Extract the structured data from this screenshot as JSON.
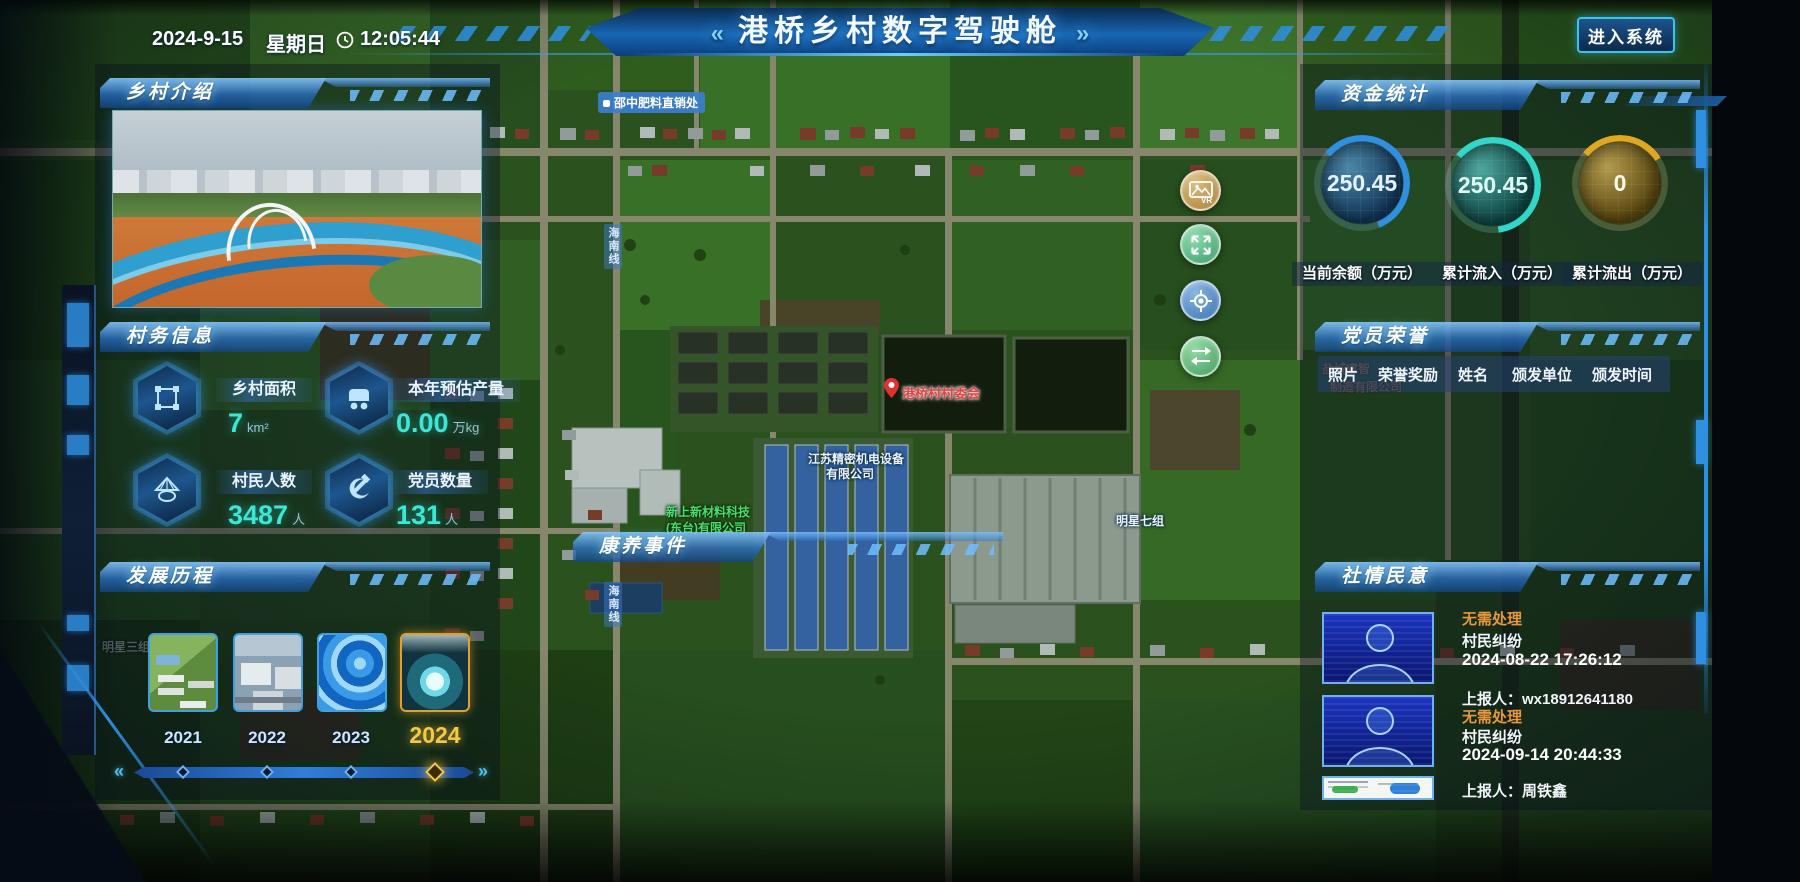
{
  "header": {
    "date": "2024-9-15",
    "weekday": "星期日",
    "time": "12:05:44",
    "title": "港桥乡村数字驾驶舱",
    "deco_left": "«",
    "deco_right": "»",
    "enter_button": "进入系统"
  },
  "colors": {
    "accent": "#39c4f0",
    "gold": "#f6c944",
    "status_orange": "#e8973c",
    "value_teal": "#3be8d8",
    "gauge_blue": "#2f8fe0",
    "gauge_teal": "#2fd8c8",
    "gauge_gold": "#e0a820"
  },
  "panels": {
    "village_intro": {
      "title": "乡村介绍"
    },
    "village_info": {
      "title": "村务信息",
      "stats": [
        {
          "icon": "land-area-icon",
          "label": "乡村面积",
          "value": "7",
          "unit": "km²"
        },
        {
          "icon": "cart-icon",
          "label": "本年预估产量",
          "value": "0.00",
          "unit": "万kg"
        },
        {
          "icon": "farmer-hat-icon",
          "label": "村民人数",
          "value": "3487",
          "unit": "人"
        },
        {
          "icon": "party-emblem-icon",
          "label": "党员数量",
          "value": "131",
          "unit": "人"
        }
      ]
    },
    "development": {
      "title": "发展历程",
      "years": [
        {
          "year": "2021",
          "active": false
        },
        {
          "year": "2022",
          "active": false
        },
        {
          "year": "2023",
          "active": false
        },
        {
          "year": "2024",
          "active": true
        }
      ],
      "slider_left": "«",
      "slider_right": "»"
    },
    "funds": {
      "title": "资金统计",
      "gauges": [
        {
          "value": "250.45",
          "label": "当前余额（万元）"
        },
        {
          "value": "250.45",
          "label": "累计流入（万元）"
        },
        {
          "value": "0",
          "label": "累计流出（万元）"
        }
      ]
    },
    "party_honor": {
      "title": "党员荣誉",
      "columns": [
        "照片",
        "荣誉奖励",
        "姓名",
        "颁发单位",
        "颁发时间"
      ]
    },
    "sentiment": {
      "title": "社情民意",
      "items": [
        {
          "status": "无需处理",
          "type": "村民纠纷",
          "time": "2024-08-22 17:26:12",
          "reporter": "上报人：wx18912641180"
        },
        {
          "status": "无需处理",
          "type": "村民纠纷",
          "time": "2024-09-14 20:44:33",
          "reporter": "上报人：周铁鑫"
        }
      ]
    }
  },
  "map": {
    "section_label": "康养事件",
    "labels": {
      "fertilizer_shop": "邵中肥料直销处",
      "road": "海南线",
      "village_committee": "港桥村村委会",
      "jiangsu_co_line1": "江苏精密机电设备",
      "jiangsu_co_line2": "有限公司",
      "xincai_co_line1": "新上新材料科技",
      "xincai_co_line2": "(东台)有限公司",
      "mingxing7": "明星七组",
      "mingxing3": "明星三组",
      "yancheng_co_line1": "盐城睿智",
      "yancheng_co_line2": "制造有限公司"
    },
    "controls": [
      {
        "name": "vr-image",
        "label": "VR"
      },
      {
        "name": "fullscreen"
      },
      {
        "name": "locate"
      },
      {
        "name": "switch"
      }
    ]
  }
}
